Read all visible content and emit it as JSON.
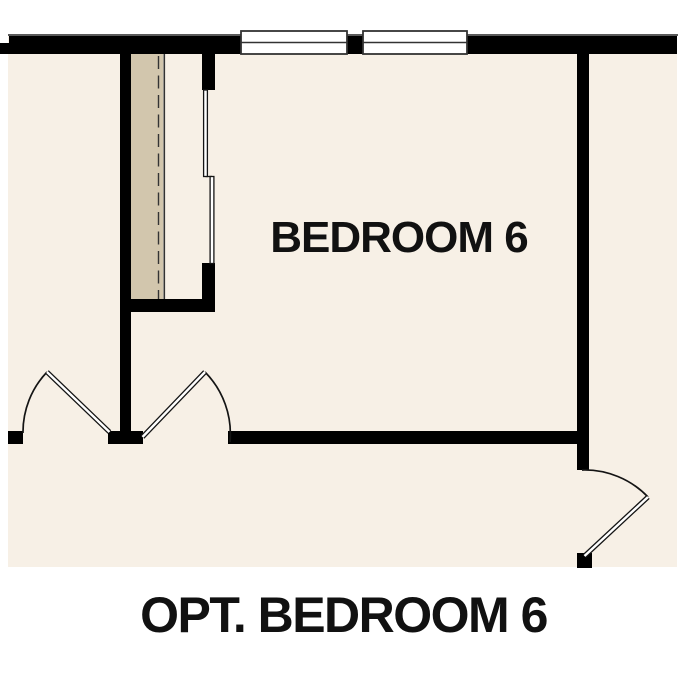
{
  "caption": "OPT. BEDROOM 6",
  "room": {
    "label": "BEDROOM 6"
  },
  "plan": {
    "type": "floor-plan",
    "windows_count": 2,
    "doors": [
      "double-swing-left-leaf",
      "double-swing-right-leaf",
      "entry-swing-door"
    ],
    "closet": "bypass-sliding-doors"
  },
  "colors": {
    "page": "#ffffff",
    "floor": "#f7f0e6",
    "wall": "#000000",
    "closetShelf": "#d2c6ad",
    "frameLine": "#333333",
    "topEdgeLine": "#5a5a5a",
    "ink": "#141414",
    "white": "#ffffff",
    "label": "#111111"
  }
}
